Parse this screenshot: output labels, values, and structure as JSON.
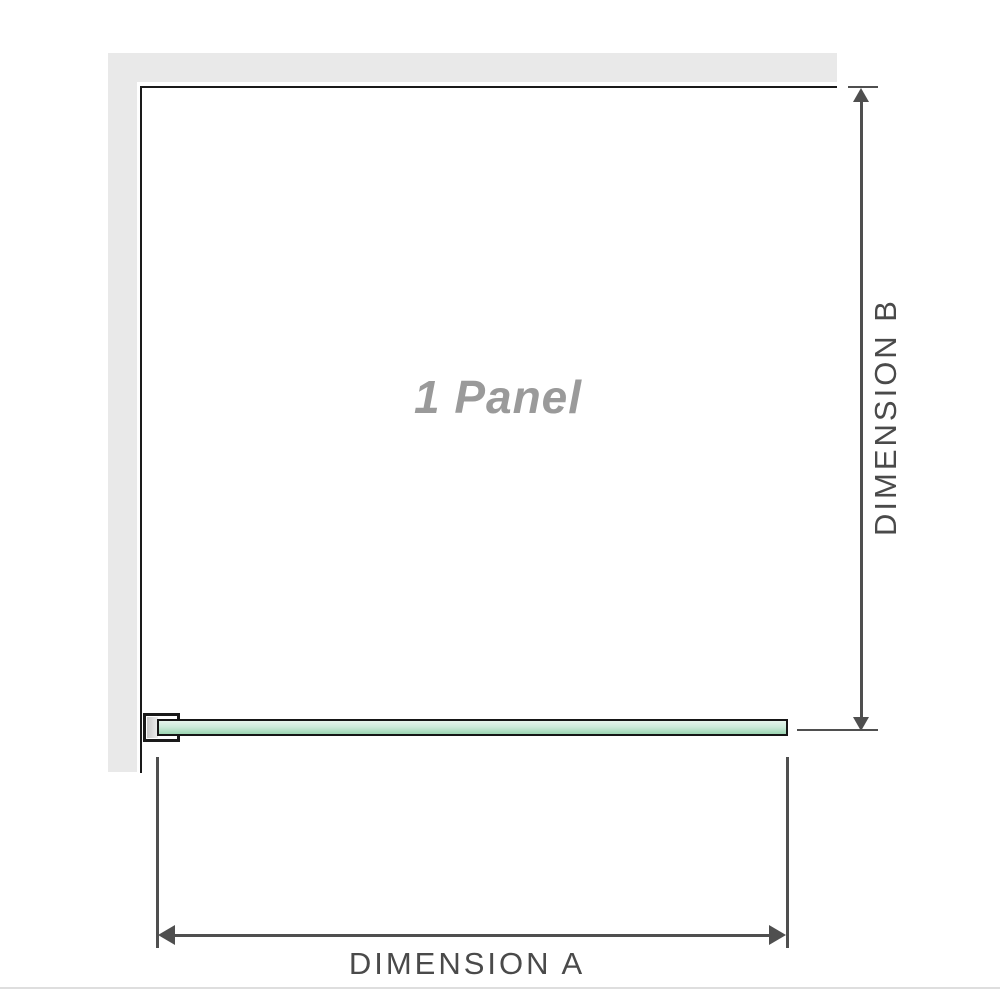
{
  "diagram": {
    "panel_label": "1 Panel",
    "dimension_a_label": "DIMENSION A",
    "dimension_b_label": "DIMENSION B"
  },
  "colors": {
    "wall": "#e9e9e9",
    "outline": "#1a1a1a",
    "dimension_line": "#4f4f4f",
    "dimension_text": "#4a4a4a",
    "panel_text": "#9a9a9a",
    "glass_border": "#161616",
    "glass_top": "#e6f5ec",
    "glass_mid": "#cdebdb",
    "glass_bottom": "#9cd5b2",
    "bracket_pad": "#c9c9c9",
    "separator": "#dedede"
  }
}
